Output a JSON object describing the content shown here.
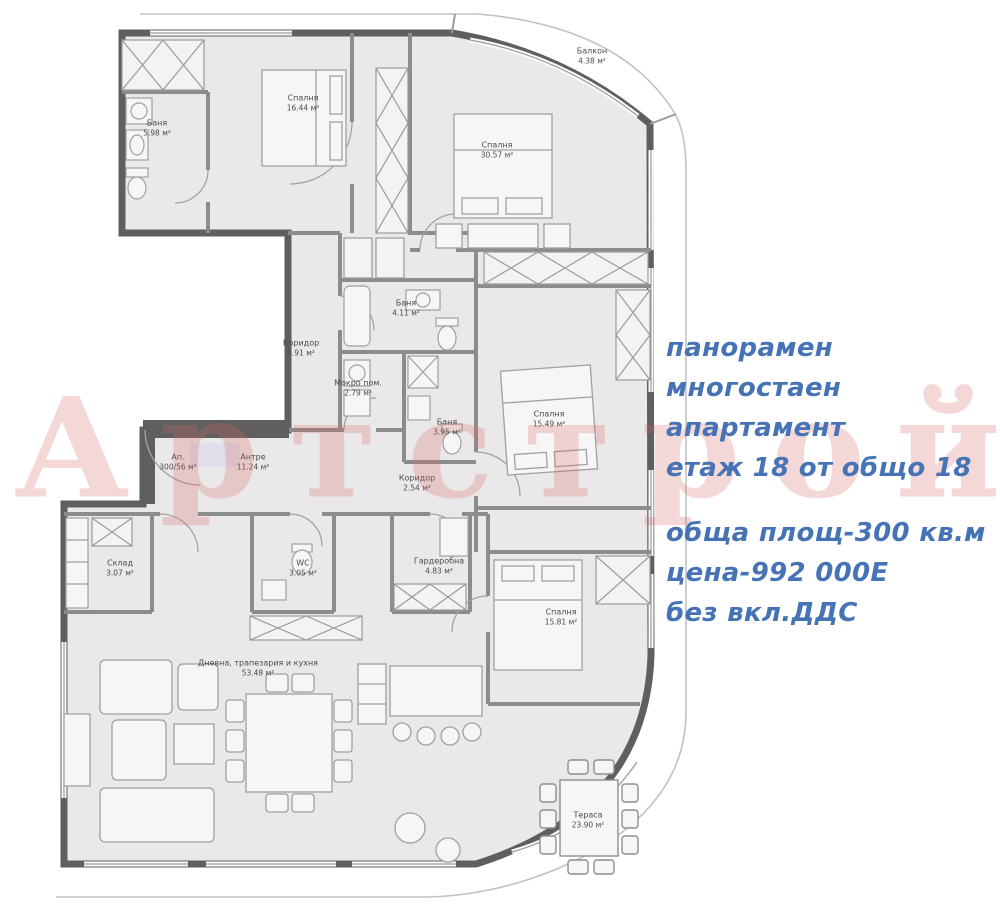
{
  "watermark": {
    "text": "Артстрой",
    "color": "#d66963"
  },
  "listing": {
    "accent_color": "#4673b6",
    "block1": [
      {
        "text": "панорамен"
      },
      {
        "text": "многостаен"
      },
      {
        "text": "апартамент"
      },
      {
        "text": "етаж 18 от общо 18"
      }
    ],
    "block2": [
      {
        "text": "обща площ-300 кв.м"
      },
      {
        "text": "цена-992 000Е"
      },
      {
        "text": "без вкл.ДДС"
      }
    ]
  },
  "rooms": [
    {
      "name": "Баня",
      "area": "5.98 м²",
      "x": 157,
      "y": 128
    },
    {
      "name": "Спалня",
      "area": "16.44 м²",
      "x": 303,
      "y": 103
    },
    {
      "name": "Спалня",
      "area": "30.57 м²",
      "x": 497,
      "y": 150
    },
    {
      "name": "Балкон",
      "area": "4.38 м²",
      "x": 592,
      "y": 56
    },
    {
      "name": "Коридор",
      "area": "6.91 м²",
      "x": 301,
      "y": 348
    },
    {
      "name": "Баня",
      "area": "4.11 м²",
      "x": 406,
      "y": 308
    },
    {
      "name": "Мокро пом.",
      "area": "2.79 м²",
      "x": 358,
      "y": 388
    },
    {
      "name": "Баня",
      "area": "3.95 м²",
      "x": 447,
      "y": 427
    },
    {
      "name": "Спалня",
      "area": "15.49 м²",
      "x": 549,
      "y": 419
    },
    {
      "name": "Ап.",
      "area": "300/56 м²",
      "x": 178,
      "y": 462
    },
    {
      "name": "Антре",
      "area": "11.24 м²",
      "x": 253,
      "y": 462
    },
    {
      "name": "Коридор",
      "area": "2.54 м²",
      "x": 417,
      "y": 483
    },
    {
      "name": "Склад",
      "area": "3.07 м²",
      "x": 120,
      "y": 568
    },
    {
      "name": "WC",
      "area": "3.05 м²",
      "x": 303,
      "y": 568
    },
    {
      "name": "Гардеробна",
      "area": "4.83 м²",
      "x": 439,
      "y": 566
    },
    {
      "name": "Спалня",
      "area": "15.81 м²",
      "x": 561,
      "y": 617
    },
    {
      "name": "Дневна, трапезария и кухня",
      "area": "53.48 м²",
      "x": 258,
      "y": 668
    },
    {
      "name": "Тераса",
      "area": "23.90 м²",
      "x": 588,
      "y": 820
    }
  ]
}
